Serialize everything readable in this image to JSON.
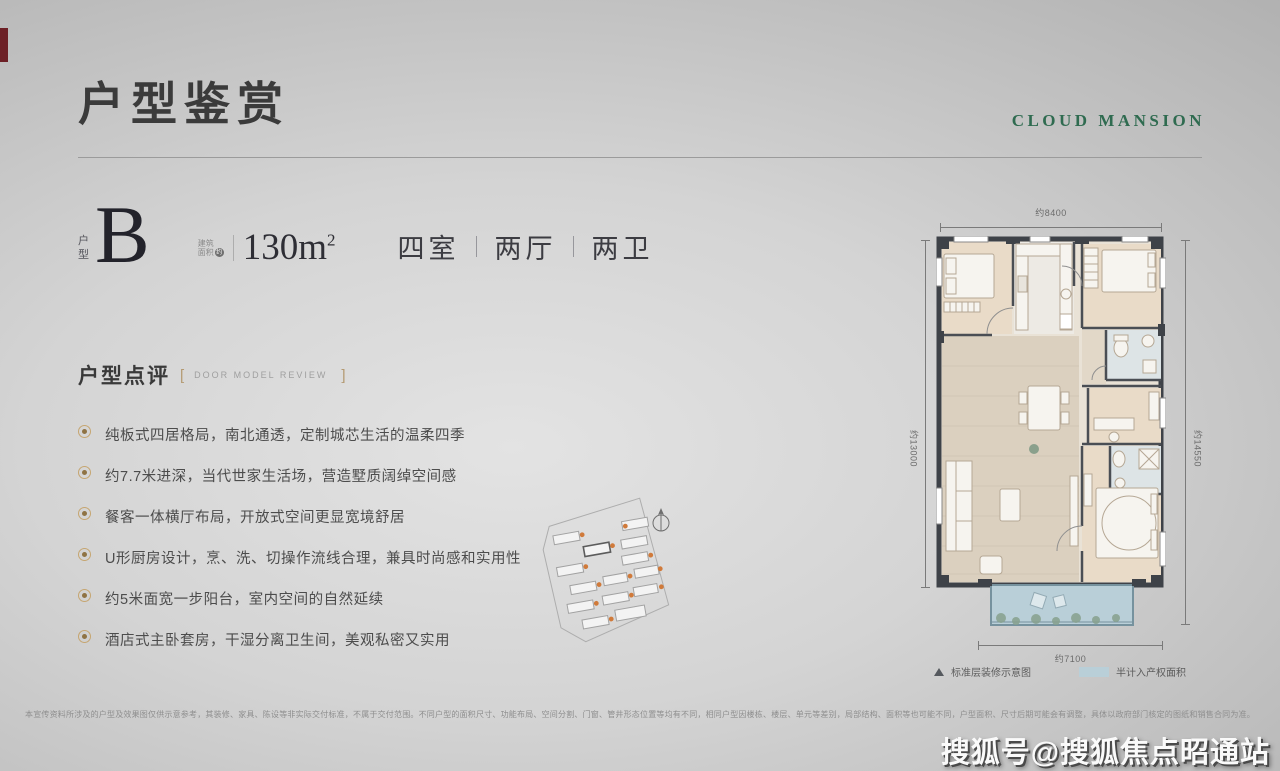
{
  "header": {
    "title": "户型鉴赏",
    "brand": "CLOUD MANSION"
  },
  "unit": {
    "type_label": "户型",
    "type_value": "B",
    "area_label_line1": "建筑",
    "area_label_line2": "面积",
    "area_label_circle": "约",
    "area_value": "130",
    "area_unit": "m",
    "area_sup": "2",
    "rooms": [
      "四室",
      "两厅",
      "两卫"
    ]
  },
  "review": {
    "heading": "户型点评",
    "heading_en": "DOOR MODEL REVIEW",
    "bracket_open": "[",
    "bracket_close": "]",
    "points": [
      "纯板式四居格局，南北通透，定制城芯生活的温柔四季",
      "约7.7米进深，当代世家生活场，营造墅质阔绰空间感",
      "餐客一体横厅布局，开放式空间更显宽境舒居",
      "U形厨房设计，烹、洗、切操作流线合理，兼具时尚感和实用性",
      "约5米面宽一步阳台，室内空间的自然延续",
      "酒店式主卧套房，干湿分离卫生间，美观私密又实用"
    ]
  },
  "floorplan": {
    "dim_top": "约8400",
    "dim_left": "约13000",
    "dim_right": "约14550",
    "dim_bottom": "约7100",
    "legend_standard": "标准层装修示意图",
    "legend_half_area": "半计入产权面积"
  },
  "footer": {
    "disclaimer": "本宣传资料所涉及的户型及效果图仅供示意参考，其装修、家具、陈设等非实际交付标准，不属于交付范围。不同户型的面积尺寸、功能布局、空间分割、门窗、管井形态位置等均有不同，相同户型因楼栋、楼层、单元等差别，局部结构、面积等也可能不同，户型面积、尺寸后期可能会有调整，具体以政府部门核定的图纸和销售合同为准。",
    "watermark": "搜狐号@搜狐焦点昭通站"
  },
  "colors": {
    "brand_green": "#2f6b50",
    "accent_gold": "#b49a72",
    "wall_dark": "#3e4248",
    "balcony_blue": "#b9cfd8",
    "site_dot_orange": "#d07a3a"
  }
}
